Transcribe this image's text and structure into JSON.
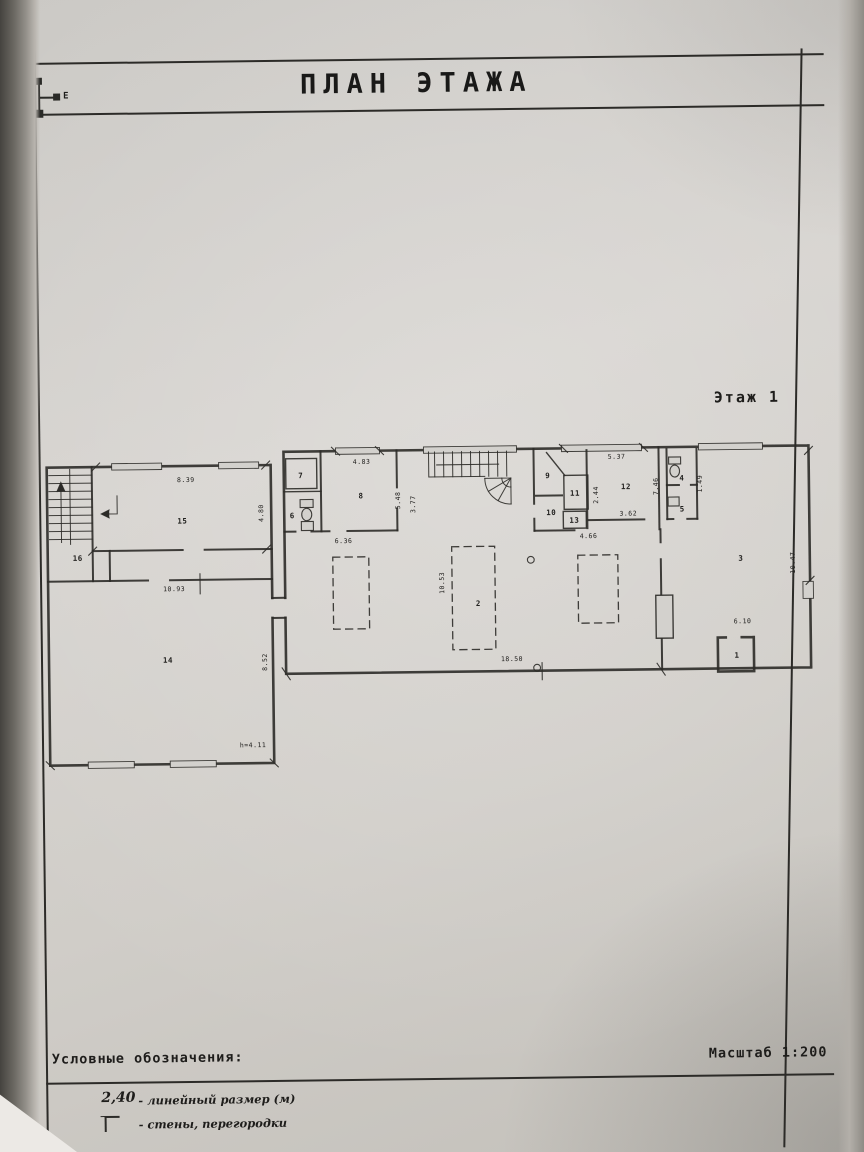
{
  "header": {
    "title": "ПЛАН ЭТАЖА"
  },
  "floor_label": "Этаж 1",
  "compass": {
    "east_label": "Е"
  },
  "plan": {
    "labels": [
      {
        "text": "1",
        "x": 736,
        "y": 659,
        "kind": "room-number"
      },
      {
        "text": "2",
        "x": 478,
        "y": 604,
        "kind": "room-number"
      },
      {
        "text": "3",
        "x": 741,
        "y": 562,
        "kind": "room-number"
      },
      {
        "text": "4",
        "x": 683,
        "y": 481,
        "kind": "room-number"
      },
      {
        "text": "5",
        "x": 683,
        "y": 512,
        "kind": "room-number"
      },
      {
        "text": "6",
        "x": 293,
        "y": 514,
        "kind": "room-number"
      },
      {
        "text": "7",
        "x": 302,
        "y": 474,
        "kind": "room-number"
      },
      {
        "text": "8",
        "x": 362,
        "y": 495,
        "kind": "room-number"
      },
      {
        "text": "9",
        "x": 549,
        "y": 477,
        "kind": "room-number"
      },
      {
        "text": "10",
        "x": 552,
        "y": 514,
        "kind": "room-number"
      },
      {
        "text": "11",
        "x": 576,
        "y": 495,
        "kind": "room-number"
      },
      {
        "text": "12",
        "x": 627,
        "y": 489,
        "kind": "room-number"
      },
      {
        "text": "13",
        "x": 575,
        "y": 522,
        "kind": "room-number"
      },
      {
        "text": "14",
        "x": 167,
        "y": 657,
        "kind": "room-number"
      },
      {
        "text": "15",
        "x": 183,
        "y": 518,
        "kind": "room-number"
      },
      {
        "text": "16",
        "x": 78,
        "y": 554,
        "kind": "room-number"
      },
      {
        "text": "8.39",
        "x": 187,
        "y": 477,
        "kind": "dimension-label"
      },
      {
        "text": "4.80",
        "x": 262,
        "y": 511,
        "rot": -90,
        "kind": "dimension-label"
      },
      {
        "text": "10.93",
        "x": 174,
        "y": 586,
        "kind": "dimension-label"
      },
      {
        "text": "8.52",
        "x": 264,
        "y": 660,
        "rot": -90,
        "kind": "dimension-label"
      },
      {
        "text": "h=4.11",
        "x": 251,
        "y": 743,
        "kind": "dimension-label"
      },
      {
        "text": "4.83",
        "x": 363,
        "y": 461,
        "kind": "dimension-label"
      },
      {
        "text": "5.48",
        "x": 399,
        "y": 500,
        "rot": -90,
        "kind": "dimension-label"
      },
      {
        "text": "3.77",
        "x": 414,
        "y": 504,
        "rot": -90,
        "kind": "dimension-label"
      },
      {
        "text": "6.36",
        "x": 344,
        "y": 540,
        "kind": "dimension-label"
      },
      {
        "text": "5.37",
        "x": 618,
        "y": 459,
        "kind": "dimension-label"
      },
      {
        "text": "2.44",
        "x": 597,
        "y": 497,
        "rot": -90,
        "kind": "dimension-label"
      },
      {
        "text": "3.62",
        "x": 629,
        "y": 516,
        "kind": "dimension-label"
      },
      {
        "text": "4.66",
        "x": 589,
        "y": 538,
        "kind": "dimension-label"
      },
      {
        "text": "7.46",
        "x": 657,
        "y": 489,
        "rot": -90,
        "kind": "dimension-label"
      },
      {
        "text": "1.49",
        "x": 701,
        "y": 487,
        "rot": -90,
        "kind": "dimension-label"
      },
      {
        "text": "10.53",
        "x": 442,
        "y": 583,
        "rot": -90,
        "kind": "dimension-label"
      },
      {
        "text": "18.50",
        "x": 511,
        "y": 660,
        "kind": "dimension-label"
      },
      {
        "text": "10.47",
        "x": 793,
        "y": 567,
        "rot": -90,
        "kind": "dimension-label"
      },
      {
        "text": "6.10",
        "x": 742,
        "y": 625,
        "kind": "dimension-label"
      }
    ]
  },
  "legend": {
    "title": "Условные обозначения:",
    "scale": "Масштаб 1:200",
    "items": [
      {
        "value": "2,40",
        "label": "- линейный размер (м)",
        "symbol": "linear-dimension"
      },
      {
        "value": "",
        "label": "- стены, перегородки",
        "symbol": "wall-corner"
      }
    ]
  }
}
